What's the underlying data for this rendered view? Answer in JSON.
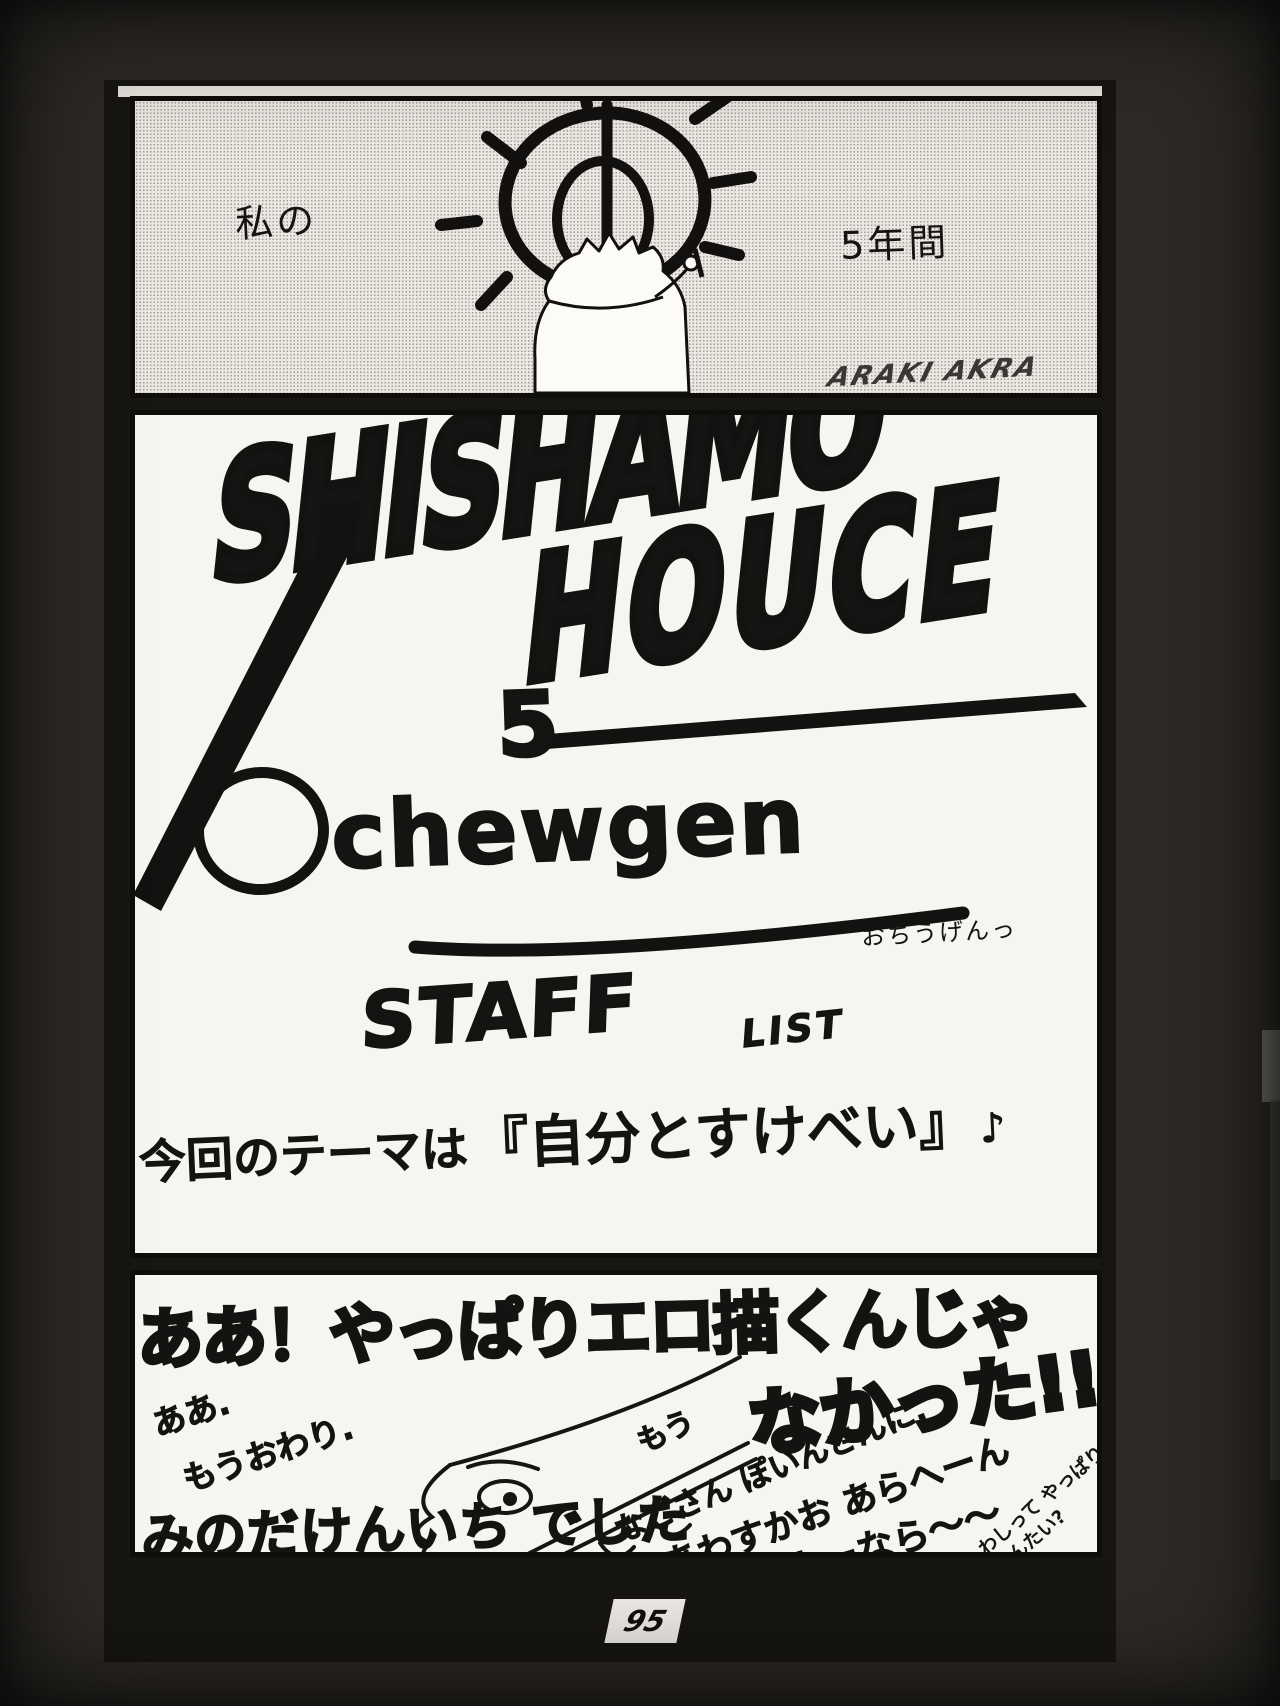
{
  "page": {
    "number": "95"
  },
  "colors": {
    "paper": "#f7f5f0",
    "ink": "#151413",
    "scan_background": "#2e2b27",
    "halftone_base": "#ebe8e3"
  },
  "top_panel": {
    "caption_left": "私の",
    "caption_right": "5年間",
    "signature": "ARAKI AKRA"
  },
  "title_panel": {
    "title_word1": "SHISHAMO",
    "title_word2": "HOUCE",
    "volume": "5",
    "subtitle_full": "Ochewgen",
    "subtitle_after_o": "chewgen",
    "subtitle_furigana": "おちうげんっ",
    "staff_label": "STAFF",
    "list_label": "LIST",
    "theme_prefix": "今回のテーマは",
    "theme_quoted": "『自分とすけべい』",
    "theme_note": "♪"
  },
  "bottom_panel": {
    "exclaim_line1": "ああ！やっぱりエロ描くんじゃ",
    "exclaim_line2": "なかった!!",
    "note_ah": "ああ.",
    "note_owari": "もうおわり.",
    "note_mou": "もう",
    "note_names": "なごさん ぽいんさんに.",
    "note_awasu": "あわすかお あらへーん",
    "note_sayonara": "さよーなら〜〜",
    "note_hentai_line1": "わしって やっぱり",
    "note_hentai_line2": "へんたい?",
    "credit": "みのだけんいち でした"
  }
}
